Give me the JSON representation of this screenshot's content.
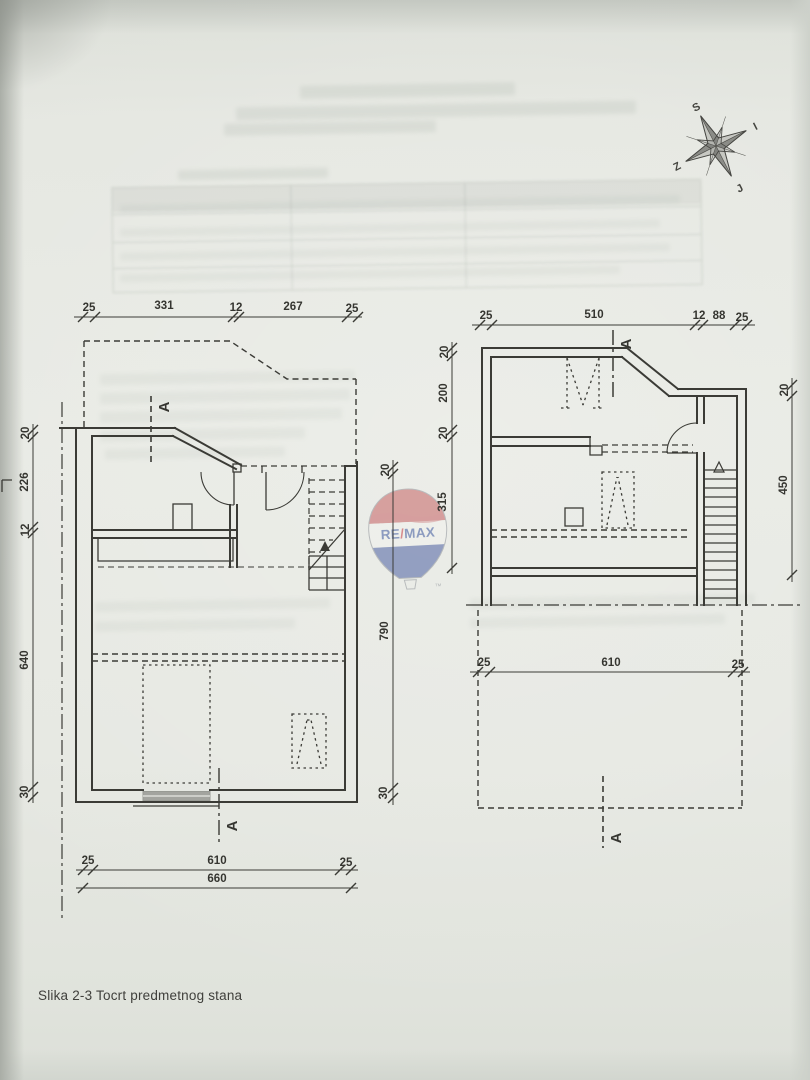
{
  "page": {
    "caption": "Slika 2-3 Tocrt predmetnog stana"
  },
  "colors": {
    "paper": "#e6e8e2",
    "ink": "#32322d",
    "logo_red": "#c4595c",
    "logo_blue": "#44599e"
  },
  "logo": {
    "re": "RE",
    "slash": "/",
    "max": "MAX",
    "tm": "™"
  },
  "compass": {
    "north": "S",
    "east": "I",
    "south": "J",
    "west": "Z"
  },
  "section_marker": {
    "label": "A"
  },
  "plans": {
    "left": {
      "dim_top": [
        "25",
        "331",
        "12",
        "267",
        "25"
      ],
      "dim_left": [
        "20",
        "226",
        "12",
        "640",
        "30"
      ],
      "dim_right": [
        "20",
        "790",
        "30"
      ],
      "dim_bottom": [
        "25",
        "610",
        "25"
      ],
      "dim_bottom_total": "660"
    },
    "right": {
      "dim_top": [
        "25",
        "510",
        "12",
        "88",
        "25"
      ],
      "dim_left": [
        "20",
        "200",
        "20",
        "315"
      ],
      "dim_right": [
        "20",
        "450"
      ],
      "dim_bottom": [
        "25",
        "610",
        "25"
      ]
    }
  }
}
